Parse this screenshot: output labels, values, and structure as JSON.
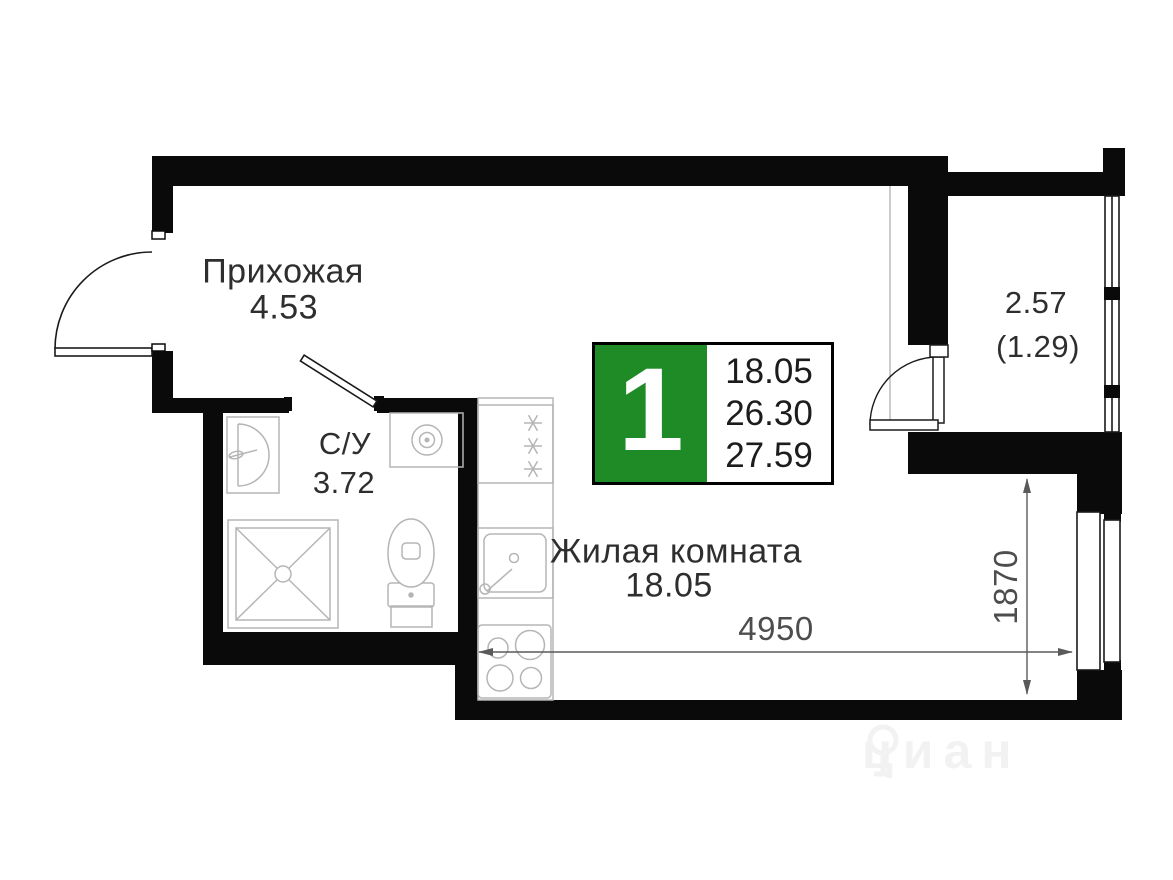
{
  "plan": {
    "type": "studio-apartment-floor-plan",
    "rooms": {
      "hallway": {
        "name": "Прихожая",
        "area": "4.53"
      },
      "bathroom": {
        "name": "С/У",
        "area": "3.72"
      },
      "living_room": {
        "name": "Жилая комната",
        "area": "18.05"
      },
      "balcony": {
        "area": "2.57",
        "area_reduced": "(1.29)"
      }
    },
    "info_badge": {
      "rooms_count": "1",
      "living_area": "18.05",
      "area_without_balcony": "26.30",
      "total_area": "27.59"
    },
    "dimensions": {
      "width_mm": "4950",
      "height_mm": "1870"
    },
    "watermark": {
      "text": "циан"
    },
    "colors": {
      "wall": "#0a0a0a",
      "accent_green": "#1f8b27",
      "fixture_line": "#b5b5b5",
      "dimension_line": "#5a5a5a",
      "text": "#2e2e2e"
    }
  }
}
